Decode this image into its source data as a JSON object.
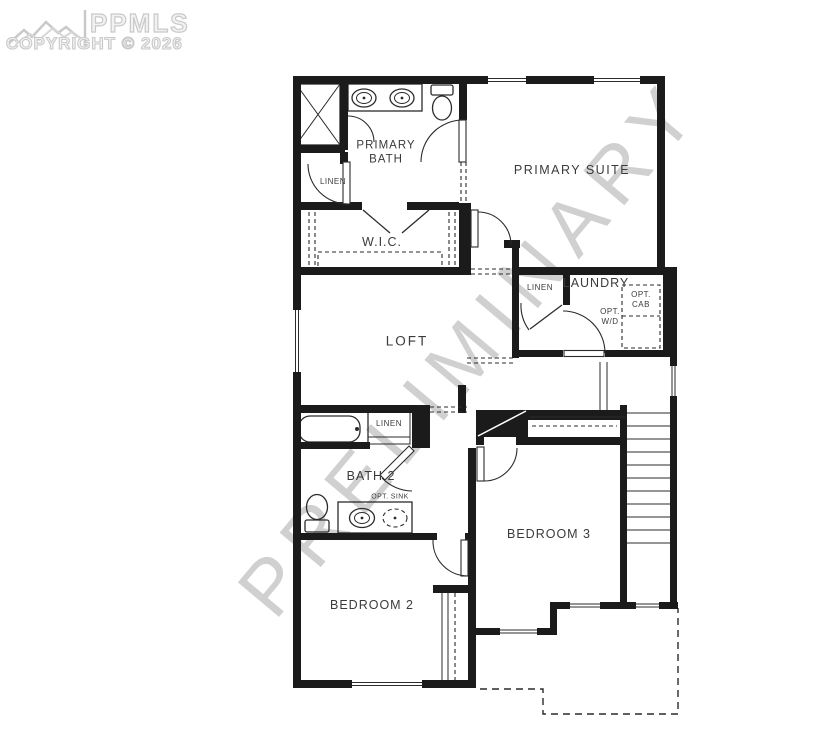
{
  "branding": {
    "logo_text": "PPMLS",
    "copyright": "COPYRIGHT © 2026"
  },
  "watermark": {
    "text": "PRELIMINARY"
  },
  "floorplan": {
    "labels": {
      "primary_bath": "PRIMARY\nBATH",
      "linen_primary": "LINEN",
      "wic": "W.I.C.",
      "primary_suite": "PRIMARY SUITE",
      "linen_laundry": "LINEN",
      "laundry": "LAUNDRY",
      "opt_wd": "OPT.\nW/D",
      "opt_cab": "OPT.\nCAB",
      "loft": "LOFT",
      "linen_bath2": "LINEN",
      "bath2": "BATH 2",
      "opt_sink": "OPT. SINK",
      "bedroom3": "BEDROOM 3",
      "bedroom2": "BEDROOM 2"
    }
  },
  "colors": {
    "wall": "#1b1b1b",
    "line": "#2b2b2b",
    "label": "#3b3b3b",
    "watermark": "#d0d0d0",
    "logo": "#c9c9c9"
  }
}
